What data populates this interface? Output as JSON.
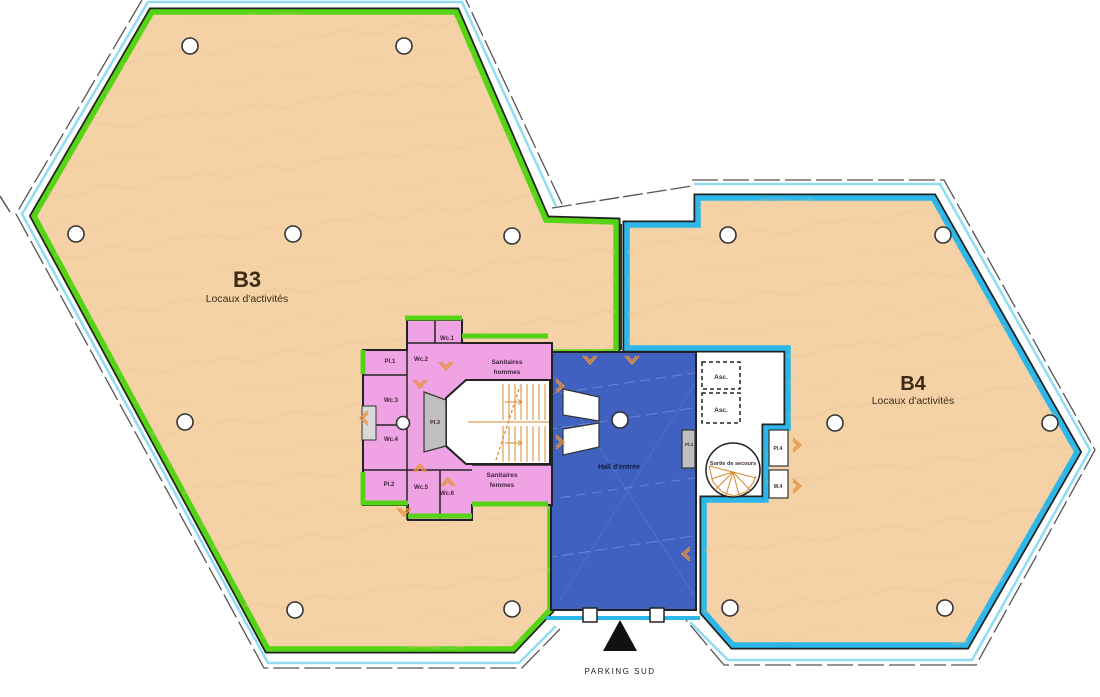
{
  "colors": {
    "b3_border": "#54d414",
    "b4_border": "#2cb7e8",
    "floor": "#f5d2a6",
    "core_pink": "#efa3e4",
    "hall_blue": "#4061c0",
    "stair_orange": "#d8892f",
    "door_orange": "#e8923a",
    "curtain_cyan": "#90dcf2",
    "wall_dark": "#222222"
  },
  "buildings": {
    "b3": {
      "code": "B3",
      "type": "Locaux d'activités"
    },
    "b4": {
      "code": "B4",
      "type": "Locaux d'activités"
    }
  },
  "core": {
    "rooms": {
      "pl1": "Pl.1",
      "wc1": "Wc.1",
      "wc2": "Wc.2",
      "wc3": "Wc.3",
      "wc4": "Wc.4",
      "pl2": "Pl.2",
      "wc5": "Wc.5",
      "wc6": "Wc.6",
      "pl3_west": "Pl.3",
      "pl3_east": "Pl.3",
      "pl4": "Pl.4",
      "w4": "W.4"
    },
    "sanitaires_hommes": {
      "line1": "Sanitaires",
      "line2": "hommes"
    },
    "sanitaires_femmes": {
      "line1": "Sanitaires",
      "line2": "femmes"
    },
    "hall": "Hall d'entrée",
    "elevator1": "Asc.",
    "elevator2": "Asc.",
    "emergency_exit": "Sortie de secours"
  },
  "site": {
    "parking_label": "PARKING SUD"
  }
}
